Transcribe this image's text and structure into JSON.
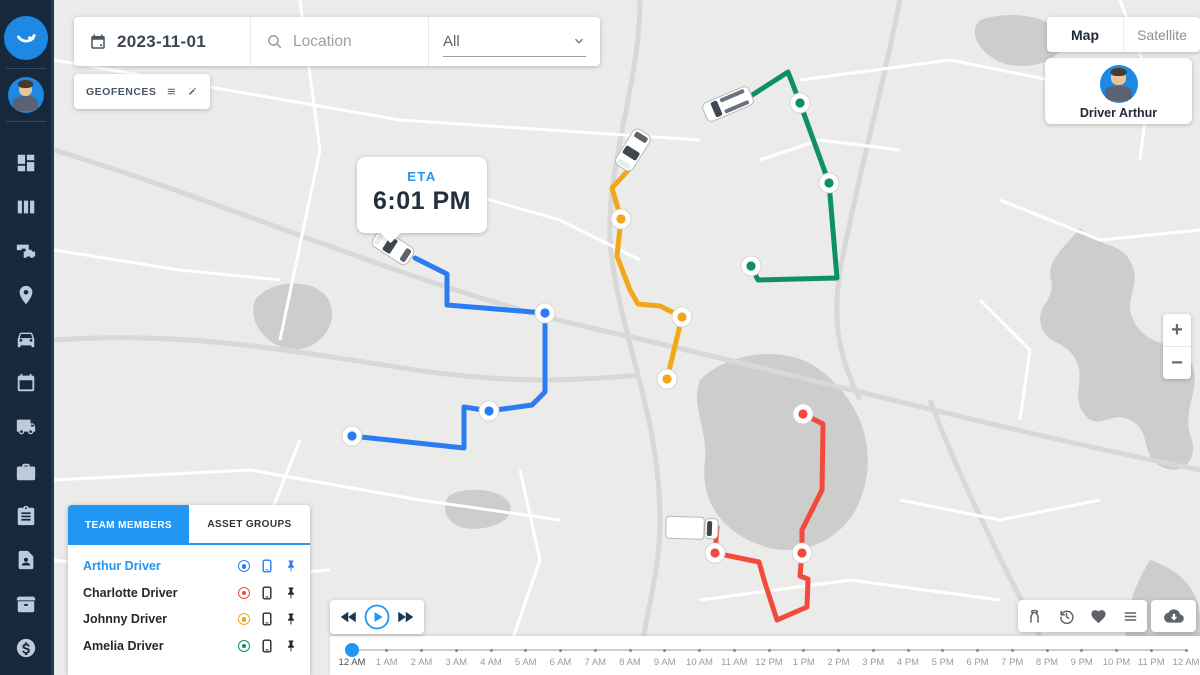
{
  "sidebar": {
    "logo_icon": "smile-logo-icon",
    "avatar_icon": "user-avatar",
    "nav_items": [
      {
        "id": "dashboard",
        "icon": "dashboard-icon"
      },
      {
        "id": "reports",
        "icon": "reports-icon"
      },
      {
        "id": "devices",
        "icon": "devices-icon"
      },
      {
        "id": "locations",
        "icon": "location-pin-icon"
      },
      {
        "id": "vehicles",
        "icon": "car-icon"
      },
      {
        "id": "schedule",
        "icon": "calendar-icon"
      },
      {
        "id": "dispatch",
        "icon": "truck-icon"
      },
      {
        "id": "jobs",
        "icon": "briefcase-icon"
      },
      {
        "id": "tasks",
        "icon": "clipboard-icon"
      },
      {
        "id": "contacts",
        "icon": "contact-file-icon"
      },
      {
        "id": "inventory",
        "icon": "archive-box-icon"
      },
      {
        "id": "billing",
        "icon": "dollar-icon"
      }
    ]
  },
  "topbar": {
    "date": "2023-11-01",
    "location_placeholder": "Location",
    "filter_value": "All"
  },
  "geofences": {
    "label": "GEOFENCES",
    "icons": [
      "list-icon",
      "draw-icon"
    ]
  },
  "map_type_toggle": {
    "options": [
      "Map",
      "Satellite"
    ],
    "active": "Map"
  },
  "driver_card": {
    "name": "Driver Arthur"
  },
  "eta_popup": {
    "label": "ETA",
    "time": "6:01 PM"
  },
  "team_panel": {
    "tabs": [
      {
        "label": "TEAM MEMBERS",
        "active": true
      },
      {
        "label": "ASSET GROUPS",
        "active": false
      }
    ],
    "members": [
      {
        "name": "Arthur Driver",
        "color": "#2b7cf2",
        "selected": true
      },
      {
        "name": "Charlotte Driver",
        "color": "#f24b3e",
        "selected": false
      },
      {
        "name": "Johnny Driver",
        "color": "#f2a71b",
        "selected": false
      },
      {
        "name": "Amelia Driver",
        "color": "#0f8f62",
        "selected": false
      }
    ]
  },
  "zoom_controls": {
    "zoom_in": "+",
    "zoom_out": "−"
  },
  "playback": {
    "buttons": [
      "rewind",
      "play",
      "fast-forward"
    ]
  },
  "route_toolbar": {
    "icons": [
      "split-route-icon",
      "history-icon",
      "heart-icon",
      "list-icon"
    ],
    "download_icon": "cloud-download-icon"
  },
  "timeline": {
    "labels": [
      "12 AM",
      "1 AM",
      "2 AM",
      "3 AM",
      "4 AM",
      "5 AM",
      "6 AM",
      "7 AM",
      "8 AM",
      "9 AM",
      "10 AM",
      "11 AM",
      "12 PM",
      "1 PM",
      "2 PM",
      "3 PM",
      "4 PM",
      "5 PM",
      "6 PM",
      "7 PM",
      "8 PM",
      "9 PM",
      "10 PM",
      "11 PM",
      "12 AM"
    ],
    "active_index": 0
  },
  "map": {
    "background": "#ebebe9",
    "routes": [
      {
        "driver": "Arthur Driver",
        "color": "#2b7cf2",
        "vehicle": {
          "type": "car",
          "x": 393,
          "y": 247,
          "angle": 33
        },
        "path": [
          [
            415,
            258
          ],
          [
            447,
            274
          ],
          [
            447,
            305
          ],
          [
            545,
            313
          ],
          [
            545,
            392
          ],
          [
            532,
            405
          ],
          [
            489,
            411
          ],
          [
            464,
            407
          ],
          [
            464,
            448
          ],
          [
            352,
            436
          ]
        ],
        "stops": [
          [
            545,
            313
          ],
          [
            489,
            411
          ],
          [
            352,
            436
          ]
        ]
      },
      {
        "driver": "Johnny Driver",
        "color": "#f2a71b",
        "vehicle": {
          "type": "car",
          "x": 633,
          "y": 150,
          "angle": -58
        },
        "path": [
          [
            633,
            165
          ],
          [
            612,
            188
          ],
          [
            621,
            219
          ],
          [
            617,
            256
          ],
          [
            630,
            290
          ],
          [
            638,
            304
          ],
          [
            660,
            306
          ],
          [
            682,
            317
          ],
          [
            667,
            379
          ]
        ],
        "stops": [
          [
            621,
            219
          ],
          [
            682,
            317
          ],
          [
            667,
            379
          ]
        ]
      },
      {
        "driver": "Amelia Driver",
        "color": "#0f8f62",
        "vehicle": {
          "type": "van",
          "x": 728,
          "y": 104,
          "angle": -23
        },
        "path": [
          [
            746,
            99
          ],
          [
            788,
            72
          ],
          [
            800,
            103
          ],
          [
            829,
            183
          ],
          [
            837,
            278
          ],
          [
            758,
            280
          ],
          [
            751,
            266
          ]
        ],
        "stops": [
          [
            800,
            103
          ],
          [
            829,
            183
          ],
          [
            751,
            266
          ]
        ]
      },
      {
        "driver": "Charlotte Driver",
        "color": "#f24b3e",
        "vehicle": {
          "type": "truck",
          "x": 692,
          "y": 528,
          "angle": 2
        },
        "path": [
          [
            803,
            414
          ],
          [
            823,
            424
          ],
          [
            822,
            490
          ],
          [
            802,
            530
          ],
          [
            802,
            553
          ],
          [
            800,
            576
          ],
          [
            808,
            579
          ],
          [
            807,
            607
          ],
          [
            777,
            620
          ],
          [
            765,
            583
          ],
          [
            759,
            562
          ],
          [
            715,
            553
          ],
          [
            717,
            527
          ],
          [
            706,
            527
          ]
        ],
        "stops": [
          [
            803,
            414
          ],
          [
            802,
            553
          ],
          [
            715,
            553
          ]
        ]
      }
    ]
  }
}
